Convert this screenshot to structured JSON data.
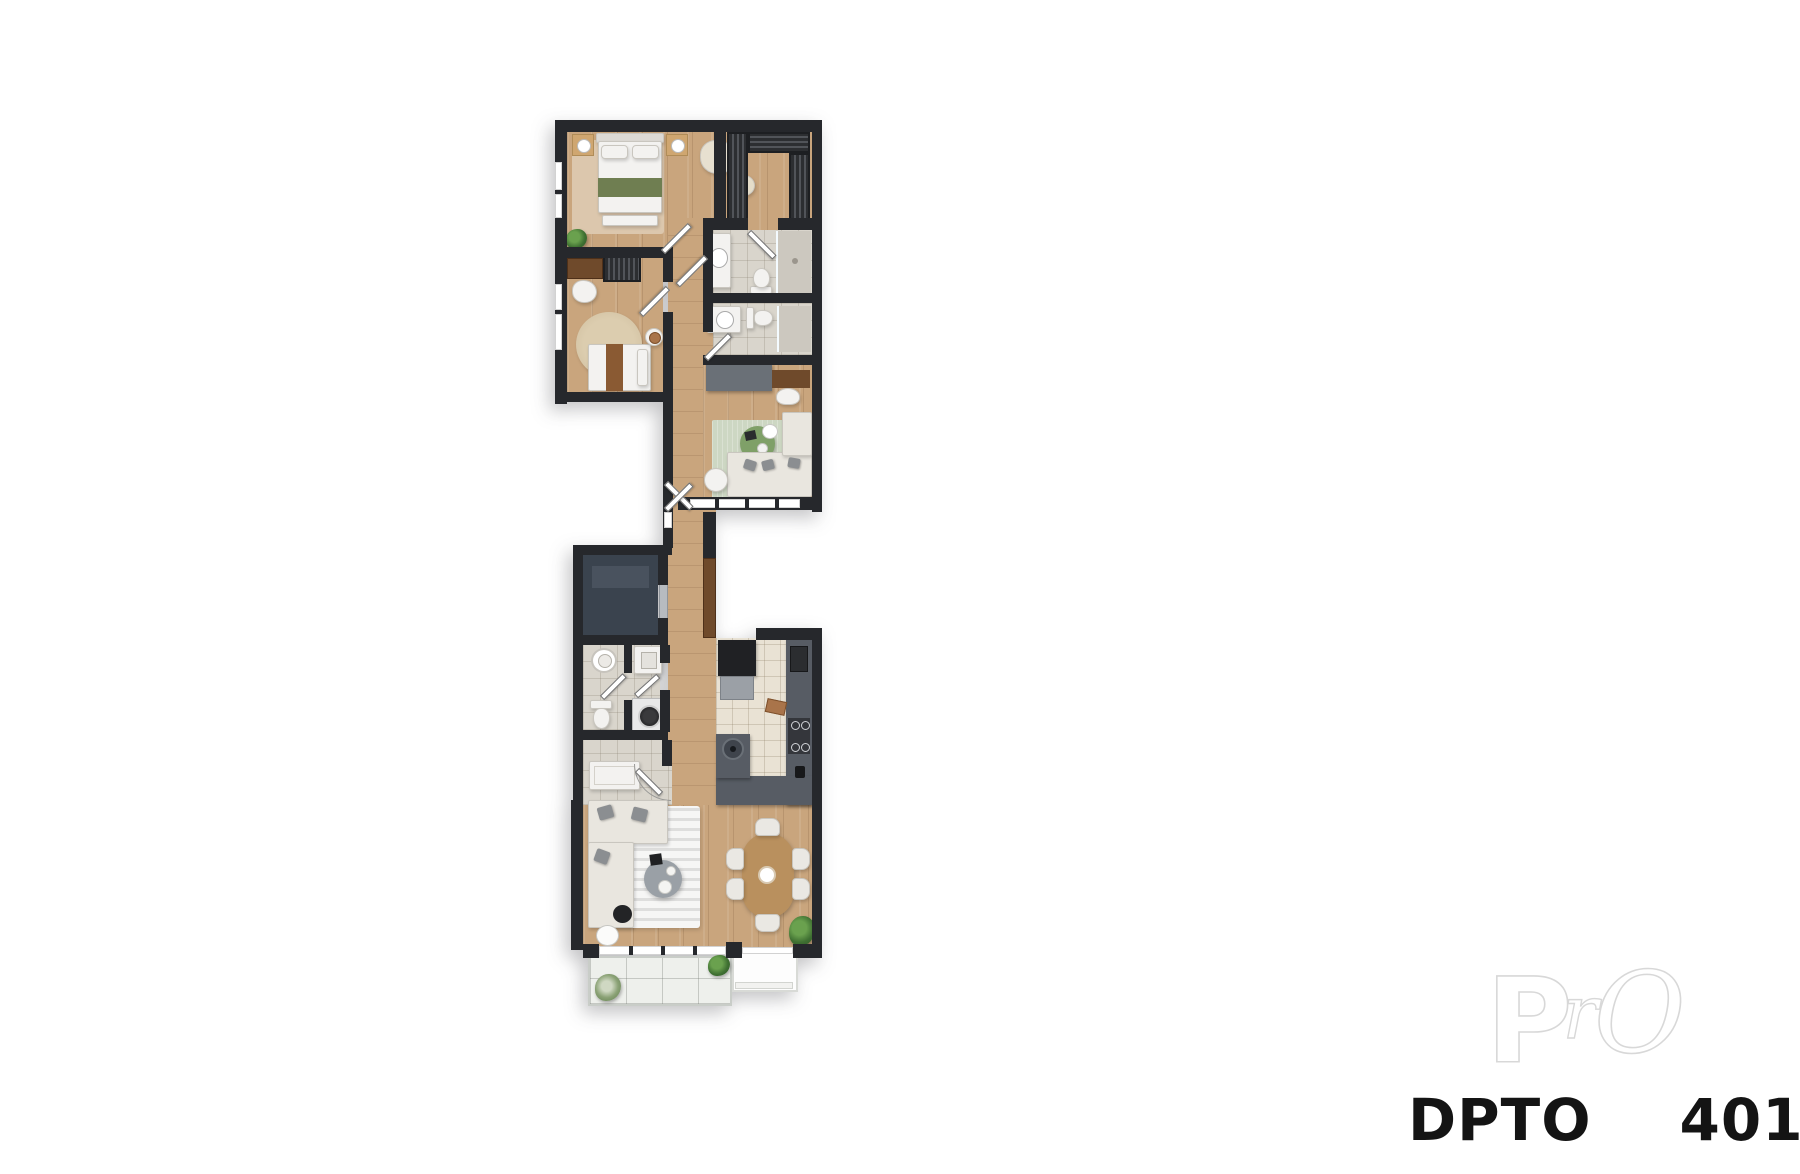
{
  "label": {
    "left": "DPTO",
    "right": "401"
  },
  "watermark": {
    "p": "P",
    "r": "r",
    "o": "O"
  },
  "colors": {
    "wall": "#26282c",
    "wood": "#c9a57d",
    "rug_master": "#dcc7ad",
    "tile_bath": "#d9d5cc",
    "tile_kitchen": "#e9e2d4",
    "tile_balcony": "#eef0ec",
    "counter": "#575c64",
    "wardrobe": "#323438",
    "wood_dark": "#6f4a2b",
    "bed_white": "#f3f2f0",
    "blanket_green": "#6f7e51",
    "rug_study": "#cdd7c3",
    "table_green": "#7fa068",
    "sofa": "#e9e6df",
    "dining_wood": "#b9905e",
    "chair": "#eae8e3",
    "plant": "#477a36",
    "elevator": "#3a434e",
    "elevator_door": "#b7bbc0",
    "appliance_dark": "#202124",
    "text": "#141414",
    "watermark": "#d8d8d8"
  }
}
